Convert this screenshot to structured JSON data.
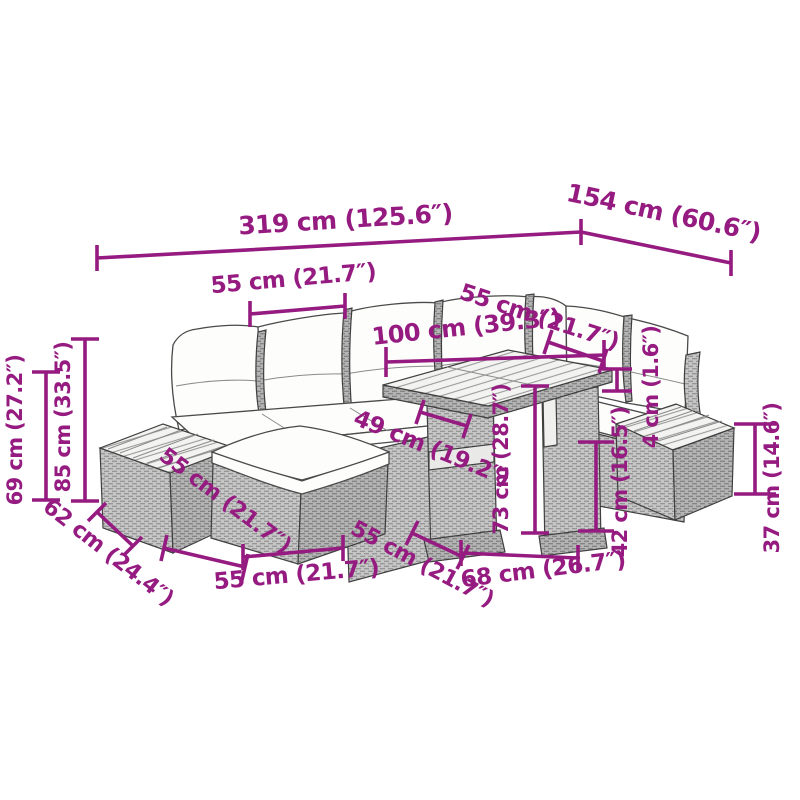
{
  "diagram": {
    "subject": "corner-sofa-set-with-tables-dimension-diagram"
  },
  "dimensions": {
    "top_total_width": "319 cm (125.6″)",
    "top_right_depth": "154 cm (60.6″)",
    "upper_left_seat_width": "55 cm (21.7″)",
    "table_top_length": "100 cm (39.3″)",
    "upper_right_seat_width": "55 cm (21.7″)",
    "tabletop_thickness": "4 cm (1.6″)",
    "back_height": "85 cm (33.5″)",
    "left_height": "69 cm (27.2″)",
    "lower_left_depth": "62 cm (24.4″)",
    "mid_left_width": "55 cm (21.7″)",
    "bottom_left_width": "55 cm (21.7″)",
    "under_table_clearance": "49 cm (19.2″)",
    "table_depth": "55 cm (21.7″)",
    "table_width": "68 cm (26.7″)",
    "table_height": "73 cm (28.7″)",
    "footstool_side_height": "42 cm (16.5″)",
    "footstool_height": "37 cm (14.6″)"
  },
  "colors": {
    "dimension_accent": "#951B81",
    "line_art": "#3F3F3F",
    "background": "#FFFFFF"
  }
}
